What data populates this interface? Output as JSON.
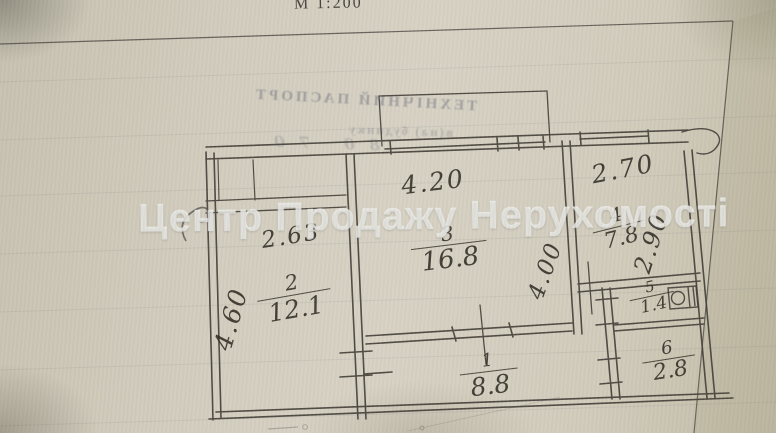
{
  "document": {
    "scale_label": "М 1:200",
    "watermark": "Центр Продажу Нерухомості",
    "bleed_title": "ТЕХНІЧНИЙ ПАСПОРТ",
    "bleed_line2": "в(на) будинку",
    "bleed_numbers": "80 70"
  },
  "floor_plan": {
    "rooms": [
      {
        "number": "1",
        "area": "8.8"
      },
      {
        "number": "2",
        "area": "12.1"
      },
      {
        "number": "3",
        "area": "16.8"
      },
      {
        "number": "4",
        "area": "7.8"
      },
      {
        "number": "5",
        "area": "1.4"
      },
      {
        "number": "6",
        "area": "2.8"
      }
    ],
    "dimensions": {
      "room3_width": "4.20",
      "room4_width": "2.70",
      "room4_depth": "2.90",
      "room3_depth": "4.00",
      "room2_width": "2.63",
      "room2_depth": "4.60"
    }
  },
  "colors": {
    "paper": "#d2cdbe",
    "ink": "#3f3b33",
    "watermark_text": "#f3f3ee"
  }
}
